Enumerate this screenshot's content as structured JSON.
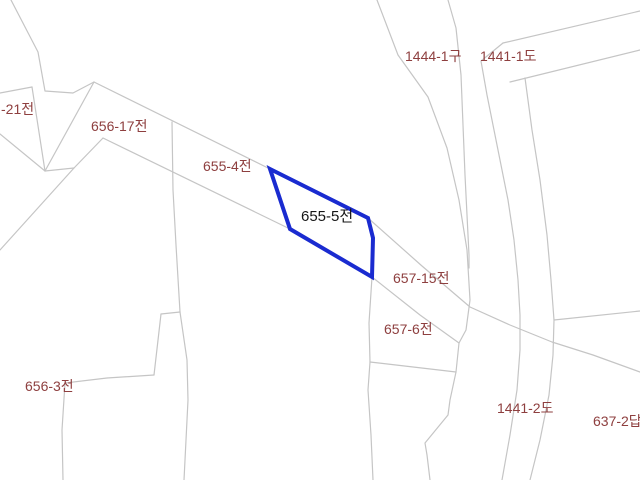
{
  "map": {
    "width": 640,
    "height": 480,
    "background": "#ffffff",
    "boundary_line_color": "#c5c5c5",
    "boundary_line_width": 1.2,
    "parcel_label_color": "#8e3f3f",
    "parcel_label_font_size": 14,
    "highlight_parcel": {
      "label": "655-5전",
      "points": "270,169 368,218 373,238 372,277 290,229",
      "stroke_color": "#1a2bd0",
      "stroke_width": 4,
      "fill": "none",
      "label_x": 301,
      "label_y": 221,
      "label_color": "#161616",
      "label_font_size": 15
    },
    "parcel_labels": [
      {
        "text": "-21전",
        "x": 1,
        "y": 114
      },
      {
        "text": "656-17전",
        "x": 91,
        "y": 131
      },
      {
        "text": "655-4전",
        "x": 203,
        "y": 171
      },
      {
        "text": "1444-1구",
        "x": 405,
        "y": 61
      },
      {
        "text": "1441-1도",
        "x": 480,
        "y": 61
      },
      {
        "text": "657-15전",
        "x": 393,
        "y": 283
      },
      {
        "text": "657-6전",
        "x": 384,
        "y": 334
      },
      {
        "text": "656-3전",
        "x": 25,
        "y": 391
      },
      {
        "text": "1441-2도",
        "x": 497,
        "y": 413
      },
      {
        "text": "637-2답",
        "x": 593,
        "y": 426
      }
    ],
    "boundaries": [
      {
        "name": "topleft-zigzag",
        "points": "11,0 38,52 45,91 73,93 94,82"
      },
      {
        "name": "parcel-21-top-edge",
        "points": "0,93 32,87"
      },
      {
        "name": "parcel-21-right-edge",
        "points": "32,87 45,171"
      },
      {
        "name": "parcel-21-bottom-edge",
        "points": "0,134 45,171"
      },
      {
        "name": "parcel-656-17-left",
        "points": "94,82 45,171"
      },
      {
        "name": "junction-connector",
        "points": "45,171 74,168"
      },
      {
        "name": "ridge-west",
        "points": "103,138 74,168 0,250"
      },
      {
        "name": "diagonal-upper",
        "points": "94,82 270,169 368,218 422,266 470,307 510,325 552,342 593,355 640,372"
      },
      {
        "name": "diagonal-lower",
        "points": "103,138 290,229 372,277 420,315 459,343"
      },
      {
        "name": "vertical-mid-left",
        "points": "172,122 173,190 176,245 180,312 187,360 188,400 184,480"
      },
      {
        "name": "jog-horizontal",
        "points": "180,312 161,314"
      },
      {
        "name": "jog-descender",
        "points": "161,314 154,375"
      },
      {
        "name": "h-line-656-3",
        "points": "154,375 107,378 65,383"
      },
      {
        "name": "left-descender",
        "points": "65,383 62,430 63,480"
      },
      {
        "name": "vertical-center",
        "points": "372,277 369,323 370,362 368,390 371,435 373,480"
      },
      {
        "name": "horizontal-segment",
        "points": "370,362 456,372"
      },
      {
        "name": "west-road-edge",
        "points": "377,0 398,55 428,97 447,148 459,200 467,250 470,300 466,330 459,343 456,372 450,400 448,415 425,443 427,455 430,480"
      },
      {
        "name": "ditch-east-edge",
        "points": "448,0 456,28 461,75 463,125 465,175 467,215 469,255 469,268"
      },
      {
        "name": "road-strip-top",
        "points": "503,43 640,11"
      },
      {
        "name": "road-strip-bottom",
        "points": "510,82 640,50"
      },
      {
        "name": "road-west-line",
        "points": "503,43 481,61 487,95 494,130 501,165 508,200 514,240 518,280 520,315 520,350 517,390 510,435 502,480"
      },
      {
        "name": "road-east-line",
        "points": "525,78 532,130 540,180 547,235 551,280 554,320 553,355 549,395 540,440 530,480"
      },
      {
        "name": "east-horizontal",
        "points": "554,320 640,311"
      }
    ]
  }
}
